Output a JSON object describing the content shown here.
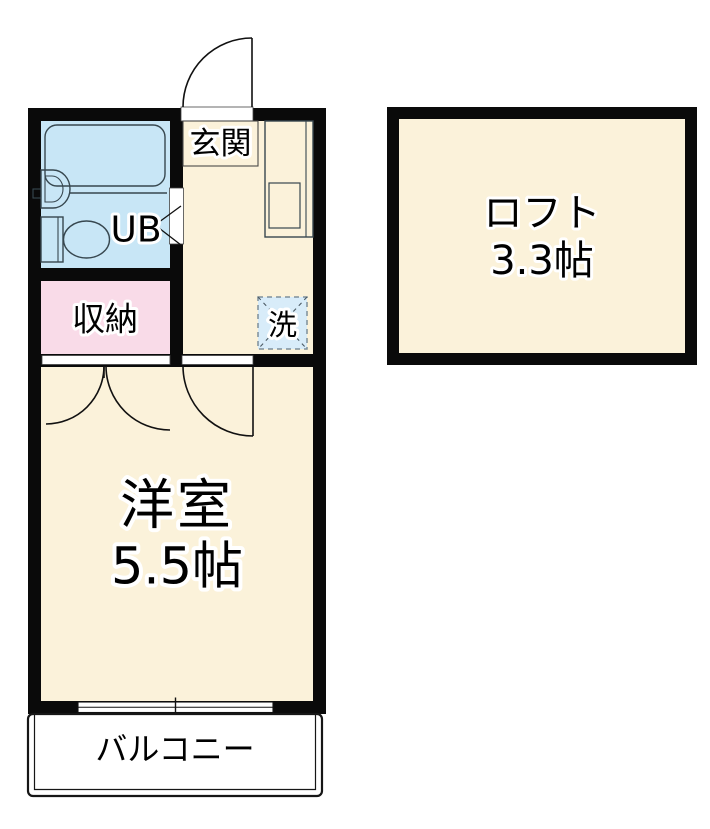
{
  "rooms": {
    "entrance": {
      "label": "玄関"
    },
    "unit_bath": {
      "label": "UB"
    },
    "storage": {
      "label": "収納"
    },
    "laundry": {
      "label": "洗"
    },
    "western_room": {
      "label": "洋室",
      "size": "5.5帖"
    },
    "balcony": {
      "label": "バルコニー"
    },
    "loft": {
      "label": "ロフト",
      "size": "3.3帖"
    }
  },
  "colors": {
    "wall": "#0a0a0a",
    "room_cream": "#fbf2da",
    "wet_area_blue": "#c8e6f6",
    "storage_pink": "#f9dbe8",
    "laundry_blue": "#d8ecf9",
    "balcony_white": "#ffffff",
    "text": "#000000",
    "text_outline": "#ffffff"
  }
}
